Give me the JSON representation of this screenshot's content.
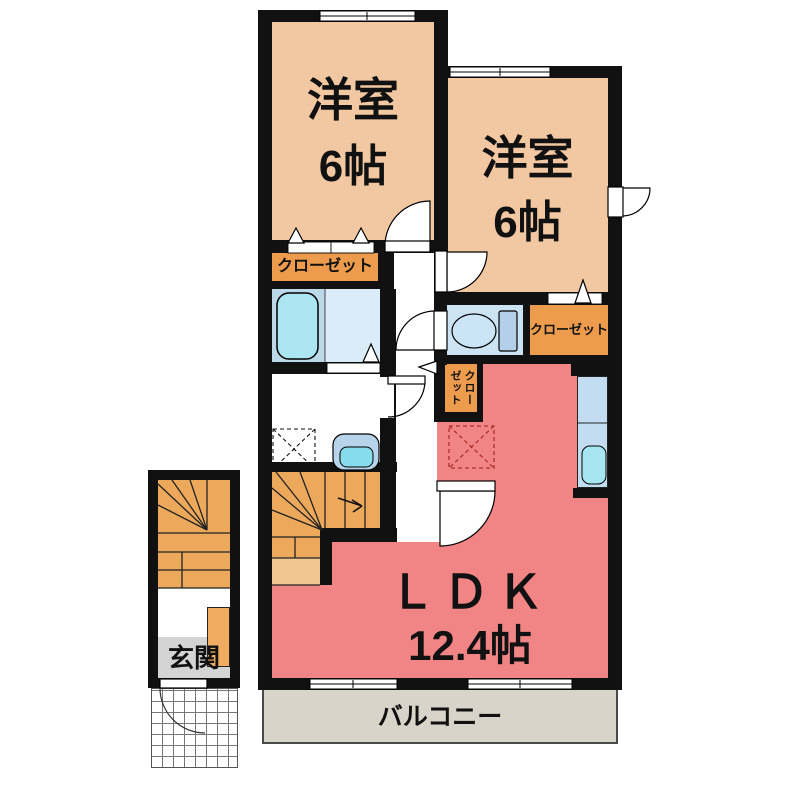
{
  "rooms": {
    "bedroom1": {
      "label": "洋室",
      "area": "6帖"
    },
    "bedroom2": {
      "label": "洋室",
      "area": "6帖"
    },
    "ldk": {
      "label": "ＬＤＫ",
      "area": "12.4帖"
    },
    "closet_bedroom1": {
      "label": "クローゼット"
    },
    "closet_bedroom2": {
      "label": "クローゼット"
    },
    "closet_hall": {
      "label": "クローゼット"
    },
    "entrance": {
      "label": "玄関"
    },
    "balcony": {
      "label": "バルコニー"
    }
  },
  "colors": {
    "wall": "#111111",
    "bedroom_floor": "#F2C8A2",
    "ldk_floor": "#F18585",
    "closet_floor": "#ED9C4D",
    "stairs_floor": "#ECA95B",
    "stairs_landing": "#F2C690",
    "bathroom_floor": "#BCD9E9",
    "toilet_floor": "#CBE3F2",
    "fixture_blue": "#A5E6F0",
    "balcony_floor": "#D9D4C9",
    "entrance_floor": "#D4D4D4",
    "refrigerator_dash": "#B03030"
  }
}
